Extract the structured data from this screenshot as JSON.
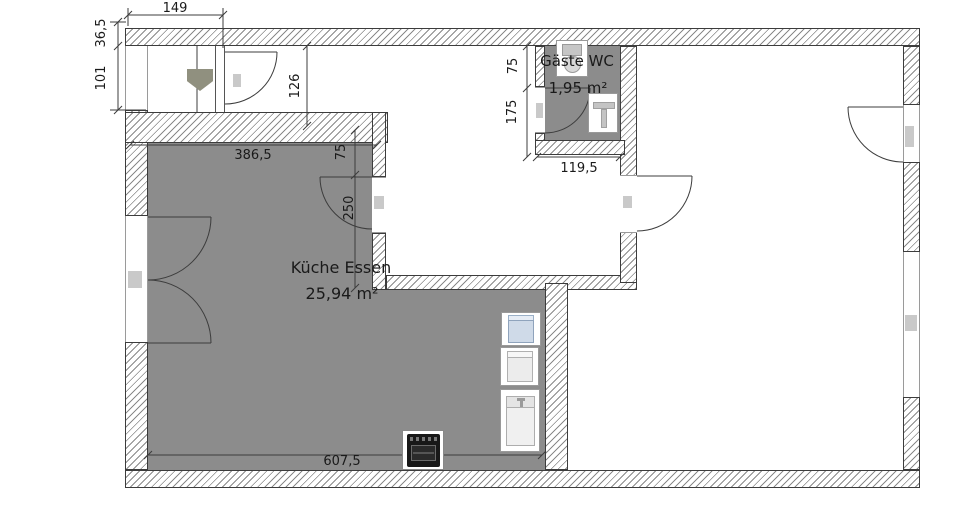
{
  "rooms": {
    "kitchen": {
      "name": "Küche Essen",
      "area": "25,94 m²"
    },
    "wc": {
      "name": "Gäste WC",
      "area": "1,95 m²"
    }
  },
  "dimensions": {
    "top_width": "149",
    "wall_thickness": "36,5",
    "left_window": "101",
    "hall_depth": "126",
    "kitchen_door_offset": "75",
    "kitchen_opening": "250",
    "kitchen_width": "386,5",
    "kitchen_length": "607,5",
    "wc_door_offset": "75",
    "wc_door_height": "175",
    "wc_width": "119,5"
  },
  "colors": {
    "room_fill": "#8C8C8C",
    "hatch": "#8A8A8A",
    "line": "#3C3C3C",
    "text": "#1A1A1A"
  }
}
